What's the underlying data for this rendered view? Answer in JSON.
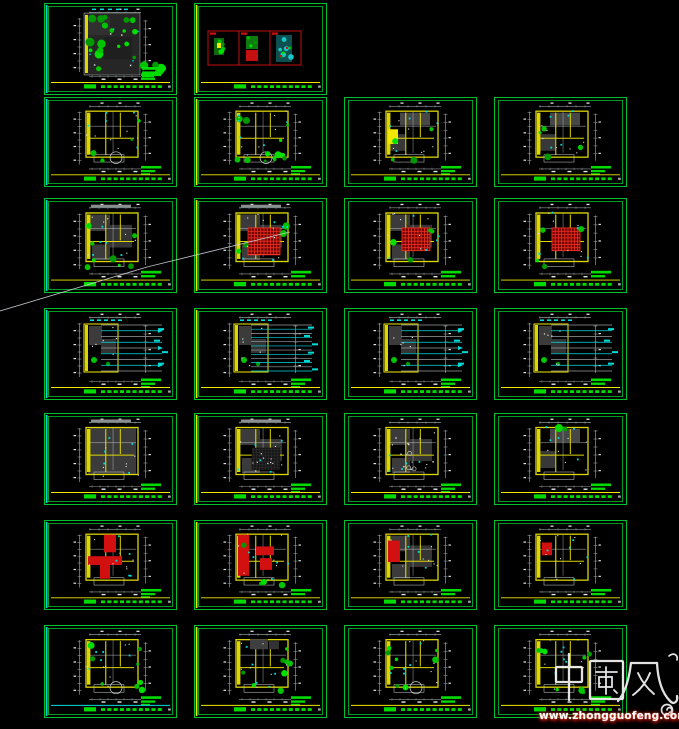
{
  "app": {
    "background": "#000000"
  },
  "watermark": {
    "title": "中國风",
    "url": "www.zhongguofeng.com",
    "text_color": "#ffffff",
    "glow_color": "#ff2812"
  },
  "palette": {
    "frame_green": "#00c32a",
    "text_green": "#00dc00",
    "wall_yellow": "#ddd600",
    "bright_yellow": "#f0e800",
    "cyan": "#00dcdc",
    "dim_gray": "#8f9898",
    "white": "#e2e6e6",
    "fill_dark": "#3b3b3b",
    "fill_gray": "#474747",
    "red": "#d21010",
    "red_hatch_base": "#6e0400",
    "red_hatch_line": "#ff3226",
    "plant_greens": [
      "#00c400",
      "#00e000",
      "#009a00"
    ]
  },
  "grid": {
    "rows": 7,
    "cols": 4,
    "sheet_w": 133,
    "col_x": [
      44,
      194,
      344,
      494
    ],
    "row_y": [
      3,
      97,
      198,
      308,
      413,
      520,
      625
    ],
    "row_h": [
      92,
      90,
      95,
      92,
      92,
      90,
      93
    ]
  },
  "stray_line": {
    "points": "0,311 147,267 290,232"
  },
  "sheets": [
    {
      "name": "sheet-r1-c1",
      "row": 1,
      "col": 1,
      "variant": "site",
      "accent": "cyan",
      "title_line": "yellow",
      "seed": 11,
      "features": []
    },
    {
      "name": "sheet-r1-c2",
      "row": 1,
      "col": 2,
      "variant": "swatches",
      "accent": "yellow",
      "title_line": "yellow",
      "seed": 12,
      "features": []
    },
    {
      "name": "sheet-r2-c1",
      "row": 2,
      "col": 1,
      "variant": "plan",
      "accent": "cyan",
      "title_line": "yellow",
      "seed": 21,
      "features": [
        "rooms",
        "green-low",
        "bay"
      ]
    },
    {
      "name": "sheet-r2-c2",
      "row": 2,
      "col": 2,
      "variant": "plan",
      "accent": "yellow",
      "title_line": "yellow",
      "seed": 22,
      "features": [
        "rooms",
        "green-high",
        "bay"
      ]
    },
    {
      "name": "sheet-r2-c3",
      "row": 2,
      "col": 3,
      "variant": "plan",
      "accent": "none",
      "title_line": "yellow",
      "seed": 23,
      "features": [
        "rooms",
        "gray",
        "yellow-room",
        "green-low"
      ]
    },
    {
      "name": "sheet-r2-c4",
      "row": 2,
      "col": 4,
      "variant": "plan",
      "accent": "none",
      "title_line": "yellow",
      "seed": 24,
      "features": [
        "rooms",
        "gray",
        "green-low"
      ]
    },
    {
      "name": "sheet-r3-c1",
      "row": 3,
      "col": 1,
      "variant": "plan",
      "accent": "cyan",
      "title_line": "yellow",
      "seed": 31,
      "features": [
        "dark",
        "green-med",
        "graybar"
      ]
    },
    {
      "name": "sheet-r3-c2",
      "row": 3,
      "col": 2,
      "variant": "plan",
      "accent": "yellow",
      "title_line": "yellow",
      "seed": 32,
      "features": [
        "dark",
        "red-hatch-big",
        "green-low",
        "graybar"
      ]
    },
    {
      "name": "sheet-r3-c3",
      "row": 3,
      "col": 3,
      "variant": "plan",
      "accent": "none",
      "title_line": "yellow",
      "seed": 33,
      "features": [
        "dark",
        "red-hatch",
        "green-low"
      ]
    },
    {
      "name": "sheet-r3-c4",
      "row": 3,
      "col": 4,
      "variant": "plan",
      "accent": "none",
      "title_line": "yellow",
      "seed": 34,
      "features": [
        "rooms",
        "red-hatch",
        "green-low"
      ]
    },
    {
      "name": "sheet-r4-c1",
      "row": 4,
      "col": 1,
      "variant": "leaders",
      "accent": "cyan",
      "title_line": "yellow",
      "seed": 41,
      "features": [
        "arrows"
      ]
    },
    {
      "name": "sheet-r4-c2",
      "row": 4,
      "col": 2,
      "variant": "leaders",
      "accent": "yellow",
      "title_line": "yellow",
      "seed": 42,
      "features": [
        "dense"
      ]
    },
    {
      "name": "sheet-r4-c3",
      "row": 4,
      "col": 3,
      "variant": "leaders",
      "accent": "none",
      "title_line": "yellow",
      "seed": 43,
      "features": [
        "arrows"
      ]
    },
    {
      "name": "sheet-r4-c4",
      "row": 4,
      "col": 4,
      "variant": "leaders",
      "accent": "none",
      "title_line": "yellow",
      "seed": 44,
      "features": []
    },
    {
      "name": "sheet-r5-c1",
      "row": 5,
      "col": 1,
      "variant": "plan",
      "accent": "cyan",
      "title_line": "yellow",
      "seed": 51,
      "features": [
        "dark-full",
        "graybar"
      ]
    },
    {
      "name": "sheet-r5-c2",
      "row": 5,
      "col": 2,
      "variant": "plan",
      "accent": "yellow",
      "title_line": "yellow",
      "seed": 52,
      "features": [
        "dark",
        "dots-grid",
        "graybar"
      ]
    },
    {
      "name": "sheet-r5-c3",
      "row": 5,
      "col": 3,
      "variant": "plan",
      "accent": "none",
      "title_line": "yellow",
      "seed": 53,
      "features": [
        "dark",
        "specks"
      ]
    },
    {
      "name": "sheet-r5-c4",
      "row": 5,
      "col": 4,
      "variant": "plan",
      "accent": "none",
      "title_line": "yellow",
      "seed": 54,
      "features": [
        "rooms",
        "gray",
        "green-top"
      ]
    },
    {
      "name": "sheet-r6-c1",
      "row": 6,
      "col": 1,
      "variant": "plan",
      "accent": "cyan",
      "title_line": "yellow",
      "seed": 61,
      "features": [
        "rooms",
        "red-big-T"
      ]
    },
    {
      "name": "sheet-r6-c2",
      "row": 6,
      "col": 2,
      "variant": "plan",
      "accent": "yellow",
      "title_line": "yellow",
      "seed": 62,
      "features": [
        "rooms",
        "red-strip",
        "green-low"
      ]
    },
    {
      "name": "sheet-r6-c3",
      "row": 6,
      "col": 3,
      "variant": "plan",
      "accent": "none",
      "title_line": "yellow",
      "seed": 63,
      "features": [
        "dark",
        "red-left"
      ]
    },
    {
      "name": "sheet-r6-c4",
      "row": 6,
      "col": 4,
      "variant": "plan",
      "accent": "none",
      "title_line": "yellow",
      "seed": 64,
      "features": [
        "rooms",
        "red-small"
      ]
    },
    {
      "name": "sheet-r7-c1",
      "row": 7,
      "col": 1,
      "variant": "plan",
      "accent": "cyan",
      "title_line": "cyan",
      "seed": 71,
      "features": [
        "rooms",
        "green-med",
        "bay"
      ]
    },
    {
      "name": "sheet-r7-c2",
      "row": 7,
      "col": 2,
      "variant": "plan",
      "accent": "yellow",
      "title_line": "yellow",
      "seed": 72,
      "features": [
        "rooms",
        "dark-top",
        "green-med"
      ]
    },
    {
      "name": "sheet-r7-c3",
      "row": 7,
      "col": 3,
      "variant": "plan",
      "accent": "none",
      "title_line": "yellow",
      "seed": 73,
      "features": [
        "rooms",
        "green-med",
        "bay"
      ]
    },
    {
      "name": "sheet-r7-c4",
      "row": 7,
      "col": 4,
      "variant": "plan",
      "accent": "none",
      "title_line": "yellow",
      "seed": 74,
      "features": [
        "rooms",
        "green-med"
      ]
    }
  ]
}
